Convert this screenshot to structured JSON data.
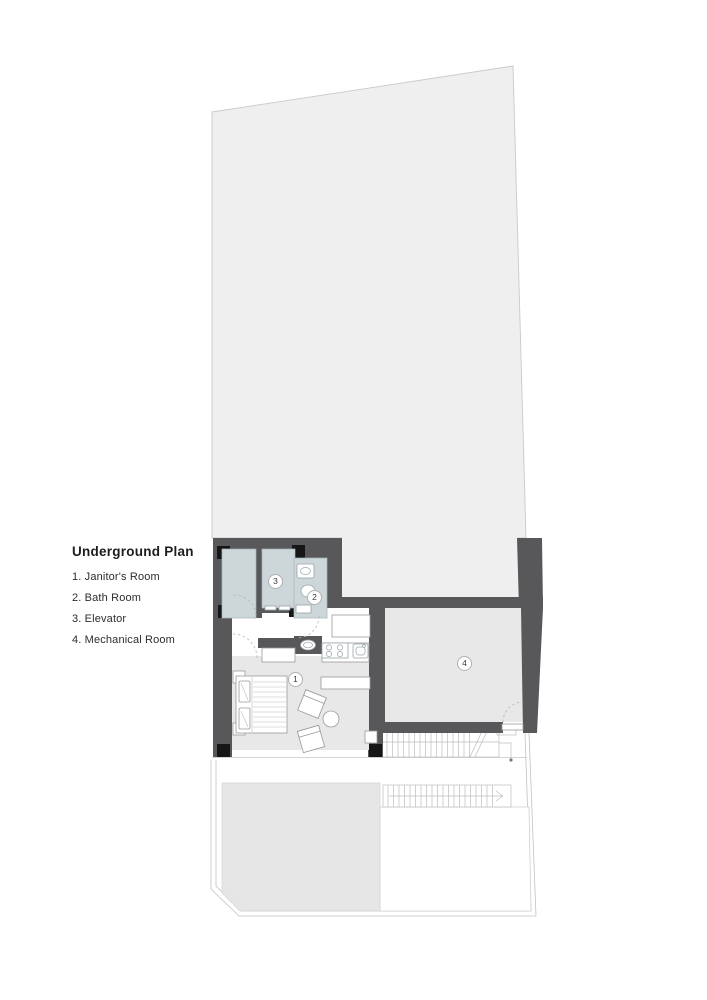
{
  "legend": {
    "title": "Underground Plan",
    "items": [
      {
        "text": "1. Janitor's Room"
      },
      {
        "text": "2. Bath Room"
      },
      {
        "text": "3. Elevator"
      },
      {
        "text": "4. Mechanical Room"
      }
    ]
  },
  "plan": {
    "markers": [
      {
        "label": "1",
        "room": "janitors-room"
      },
      {
        "label": "2",
        "room": "bath-room"
      },
      {
        "label": "3",
        "room": "elevator"
      },
      {
        "label": "4",
        "room": "mechanical-room"
      }
    ],
    "colors": {
      "wall": "#58585a",
      "column": "#161616",
      "lot_fill": "#efeff0",
      "wet_room_fill": "#cdd6d9",
      "floor_fill": "#e8e8e9",
      "terrace_fill": "#e6e6e6",
      "outline": "#c2c2c2",
      "marker_border": "#b0b0b0"
    }
  }
}
